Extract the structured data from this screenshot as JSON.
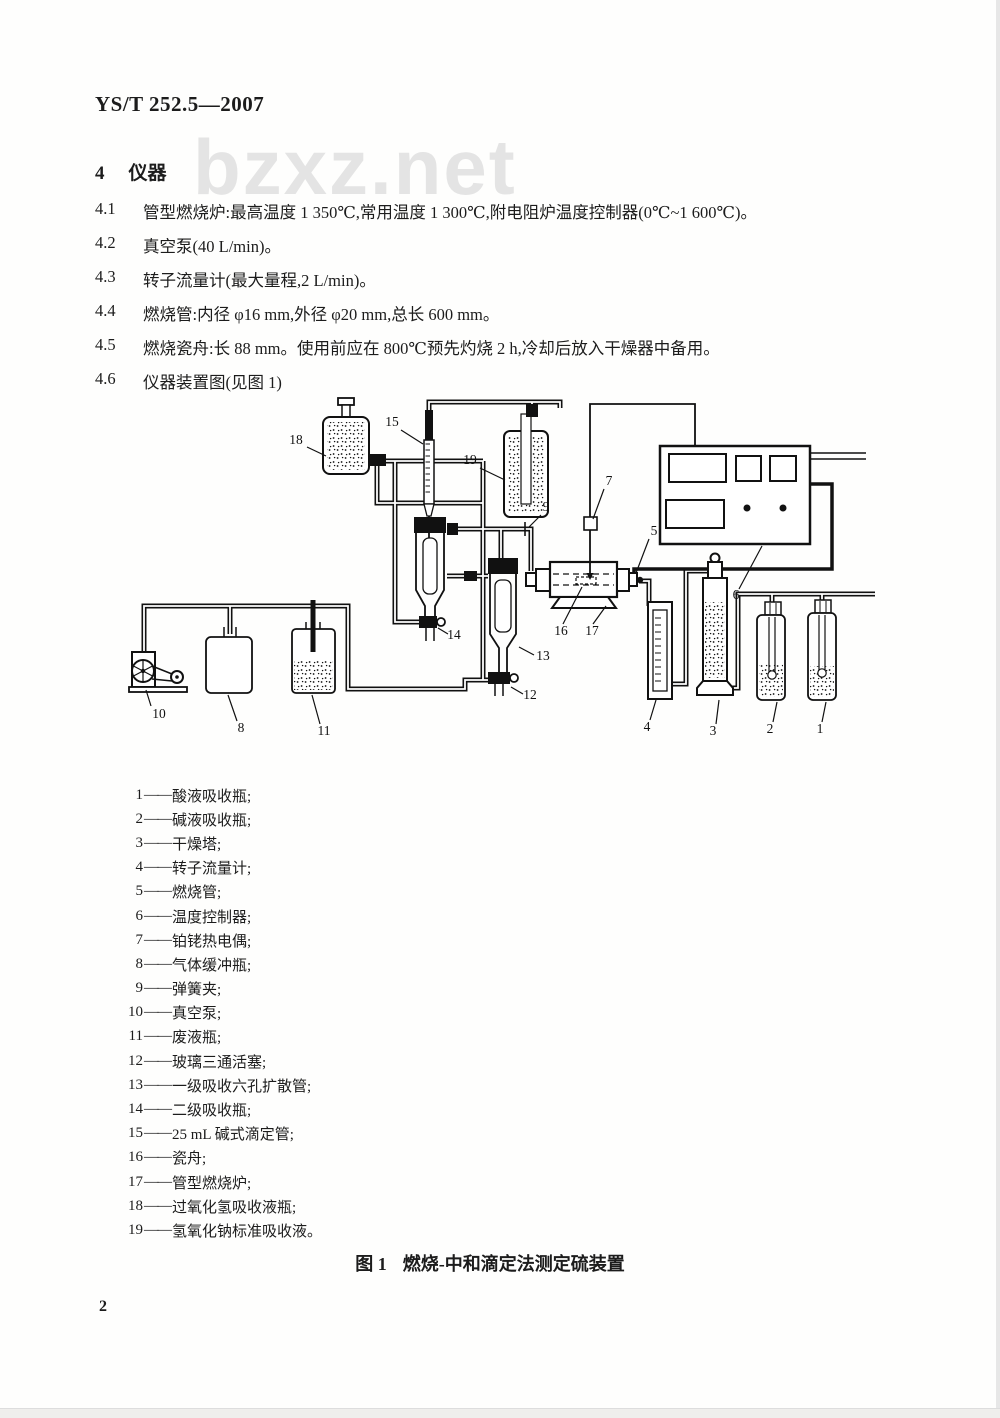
{
  "header": {
    "doc_number": "YS/T 252.5—2007"
  },
  "watermark": {
    "text": "bzxz.net"
  },
  "section": {
    "number": "4",
    "title": "仪器"
  },
  "clauses": [
    {
      "num": "4.1",
      "text": "管型燃烧炉:最高温度 1 350℃,常用温度 1 300℃,附电阻炉温度控制器(0℃~1 600℃)。"
    },
    {
      "num": "4.2",
      "text": "真空泵(40 L/min)。"
    },
    {
      "num": "4.3",
      "text": "转子流量计(最大量程,2 L/min)。"
    },
    {
      "num": "4.4",
      "text": "燃烧管:内径 φ16 mm,外径 φ20 mm,总长 600 mm。"
    },
    {
      "num": "4.5",
      "text": "燃烧瓷舟:长 88 mm。使用前应在 800℃预先灼烧 2 h,冷却后放入干燥器中备用。"
    },
    {
      "num": "4.6",
      "text": "仪器装置图(见图 1)"
    }
  ],
  "diagram": {
    "labels": [
      "1",
      "2",
      "3",
      "4",
      "5",
      "6",
      "7",
      "8",
      "9",
      "10",
      "11",
      "12",
      "13",
      "14",
      "15",
      "16",
      "17",
      "18",
      "19"
    ]
  },
  "legend": {
    "dash": "——",
    "items": [
      {
        "num": "1",
        "name": "酸液吸收瓶;"
      },
      {
        "num": "2",
        "name": "碱液吸收瓶;"
      },
      {
        "num": "3",
        "name": "干燥塔;"
      },
      {
        "num": "4",
        "name": "转子流量计;"
      },
      {
        "num": "5",
        "name": "燃烧管;"
      },
      {
        "num": "6",
        "name": "温度控制器;"
      },
      {
        "num": "7",
        "name": "铂铑热电偶;"
      },
      {
        "num": "8",
        "name": "气体缓冲瓶;"
      },
      {
        "num": "9",
        "name": "弹簧夹;"
      },
      {
        "num": "10",
        "name": "真空泵;"
      },
      {
        "num": "11",
        "name": "废液瓶;"
      },
      {
        "num": "12",
        "name": "玻璃三通活塞;"
      },
      {
        "num": "13",
        "name": "一级吸收六孔扩散管;"
      },
      {
        "num": "14",
        "name": "二级吸收瓶;"
      },
      {
        "num": "15",
        "name": "25 mL 碱式滴定管;"
      },
      {
        "num": "16",
        "name": "瓷舟;"
      },
      {
        "num": "17",
        "name": "管型燃烧炉;"
      },
      {
        "num": "18",
        "name": "过氧化氢吸收液瓶;"
      },
      {
        "num": "19",
        "name": "氢氧化钠标准吸收液。"
      }
    ]
  },
  "figure": {
    "caption_label": "图 1",
    "caption_title": "燃烧-中和滴定法测定硫装置"
  },
  "footer": {
    "page_number": "2"
  }
}
